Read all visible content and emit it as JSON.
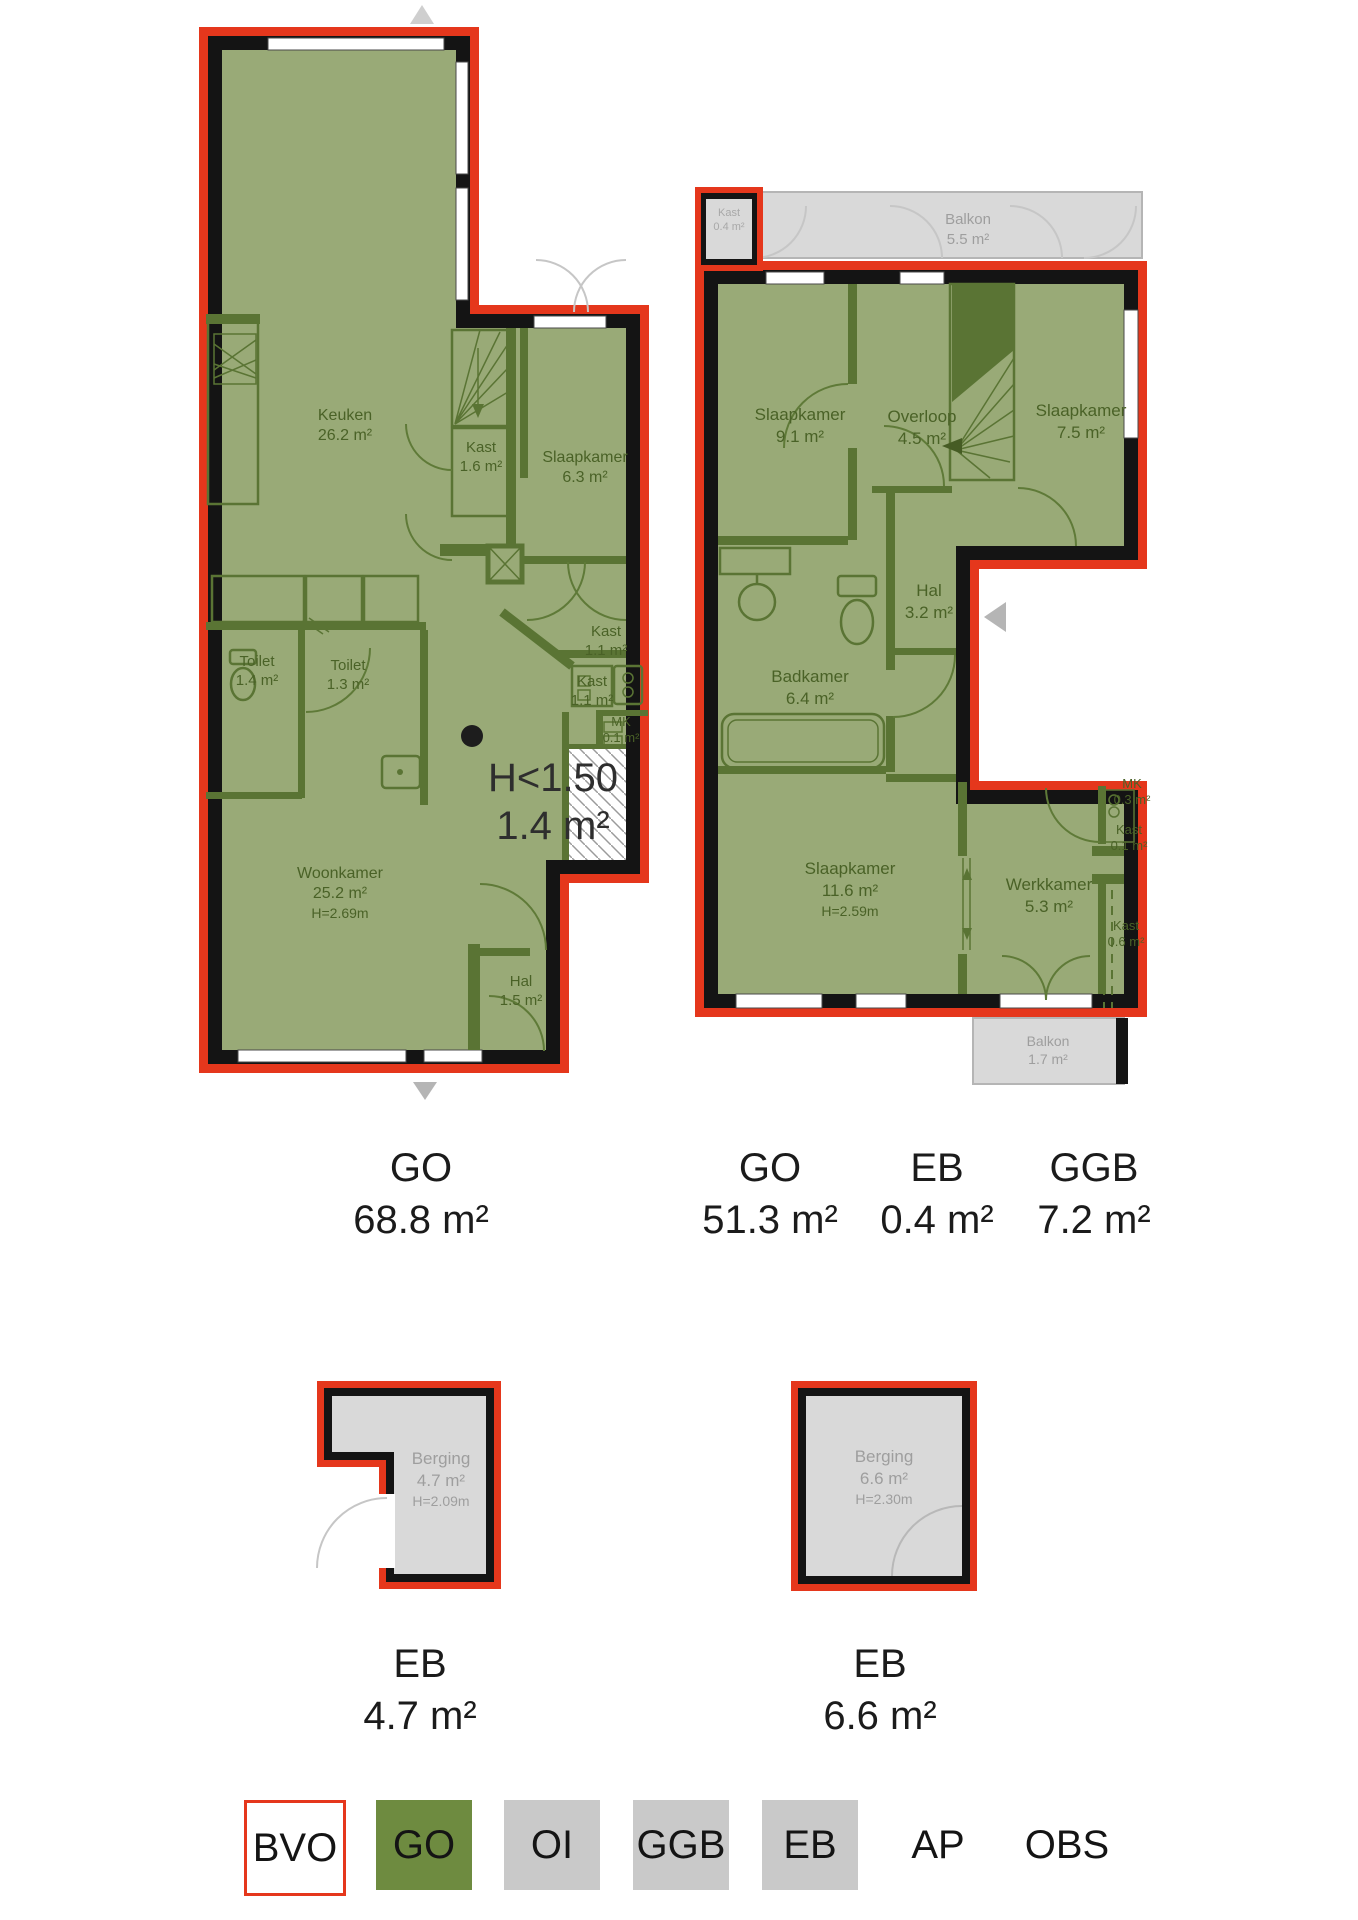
{
  "plan1": {
    "rooms": [
      {
        "name": "Keuken",
        "area": "26.2 m²"
      },
      {
        "name": "Kast",
        "area": "1.6 m²"
      },
      {
        "name": "Slaapkamer",
        "area": "6.3 m²"
      },
      {
        "name": "Kast",
        "area": "1.1 m²"
      },
      {
        "name": "Kast",
        "area": "1.1 m²"
      },
      {
        "name": "MK",
        "area": "0.1 m²"
      },
      {
        "name": "Toilet",
        "area": "1.4 m²"
      },
      {
        "name": "Toilet",
        "area": "1.3 m²"
      },
      {
        "name": "Woonkamer",
        "area": "25.2 m²",
        "height": "H=2.69m"
      },
      {
        "name": "Hal",
        "area": "1.5 m²"
      }
    ],
    "low_ceiling": {
      "line1": "H<1.50",
      "line2": "1.4 m²"
    }
  },
  "plan2": {
    "rooms": [
      {
        "name": "Kast",
        "area": "0.4 m²"
      },
      {
        "name": "Balkon",
        "area": "5.5 m²"
      },
      {
        "name": "Slaapkamer",
        "area": "9.1 m²"
      },
      {
        "name": "Overloop",
        "area": "4.5 m²"
      },
      {
        "name": "Slaapkamer",
        "area": "7.5 m²"
      },
      {
        "name": "Hal",
        "area": "3.2 m²"
      },
      {
        "name": "Badkamer",
        "area": "6.4 m²"
      },
      {
        "name": "Slaapkamer",
        "area": "11.6 m²",
        "height": "H=2.59m"
      },
      {
        "name": "Werkkamer",
        "area": "5.3 m²"
      },
      {
        "name": "MK",
        "area": "0.3 m²"
      },
      {
        "name": "Kast",
        "area": "0.1 m²"
      },
      {
        "name": "Kast",
        "area": "0.6 m²"
      },
      {
        "name": "Balkon",
        "area": "1.7 m²"
      }
    ]
  },
  "summary_row1": [
    {
      "code": "GO",
      "value": "68.8 m²"
    },
    {
      "code": "GO",
      "value": "51.3 m²"
    },
    {
      "code": "EB",
      "value": "0.4 m²"
    },
    {
      "code": "GGB",
      "value": "7.2 m²"
    }
  ],
  "storage": [
    {
      "name": "Berging",
      "area": "4.7 m²",
      "height": "H=2.09m"
    },
    {
      "name": "Berging",
      "area": "6.6 m²",
      "height": "H=2.30m"
    }
  ],
  "summary_row2": [
    {
      "code": "EB",
      "value": "4.7 m²"
    },
    {
      "code": "EB",
      "value": "6.6 m²"
    }
  ],
  "legend": {
    "items": [
      {
        "label": "BVO",
        "swatch": "outline"
      },
      {
        "label": "GO",
        "swatch": "green"
      },
      {
        "label": "OI",
        "swatch": "gray"
      },
      {
        "label": "GGB",
        "swatch": "gray"
      },
      {
        "label": "EB",
        "swatch": "gray"
      },
      {
        "label": "AP",
        "swatch": "none"
      },
      {
        "label": "OBS",
        "swatch": "none"
      }
    ]
  },
  "colors": {
    "outline_red": "#e5371c",
    "wall_black": "#141414",
    "go_green": "#6e8b40",
    "room_fill": "#99aa77",
    "legend_gray": "#c9c9c9",
    "balcony_gray": "#d9d9d9"
  }
}
